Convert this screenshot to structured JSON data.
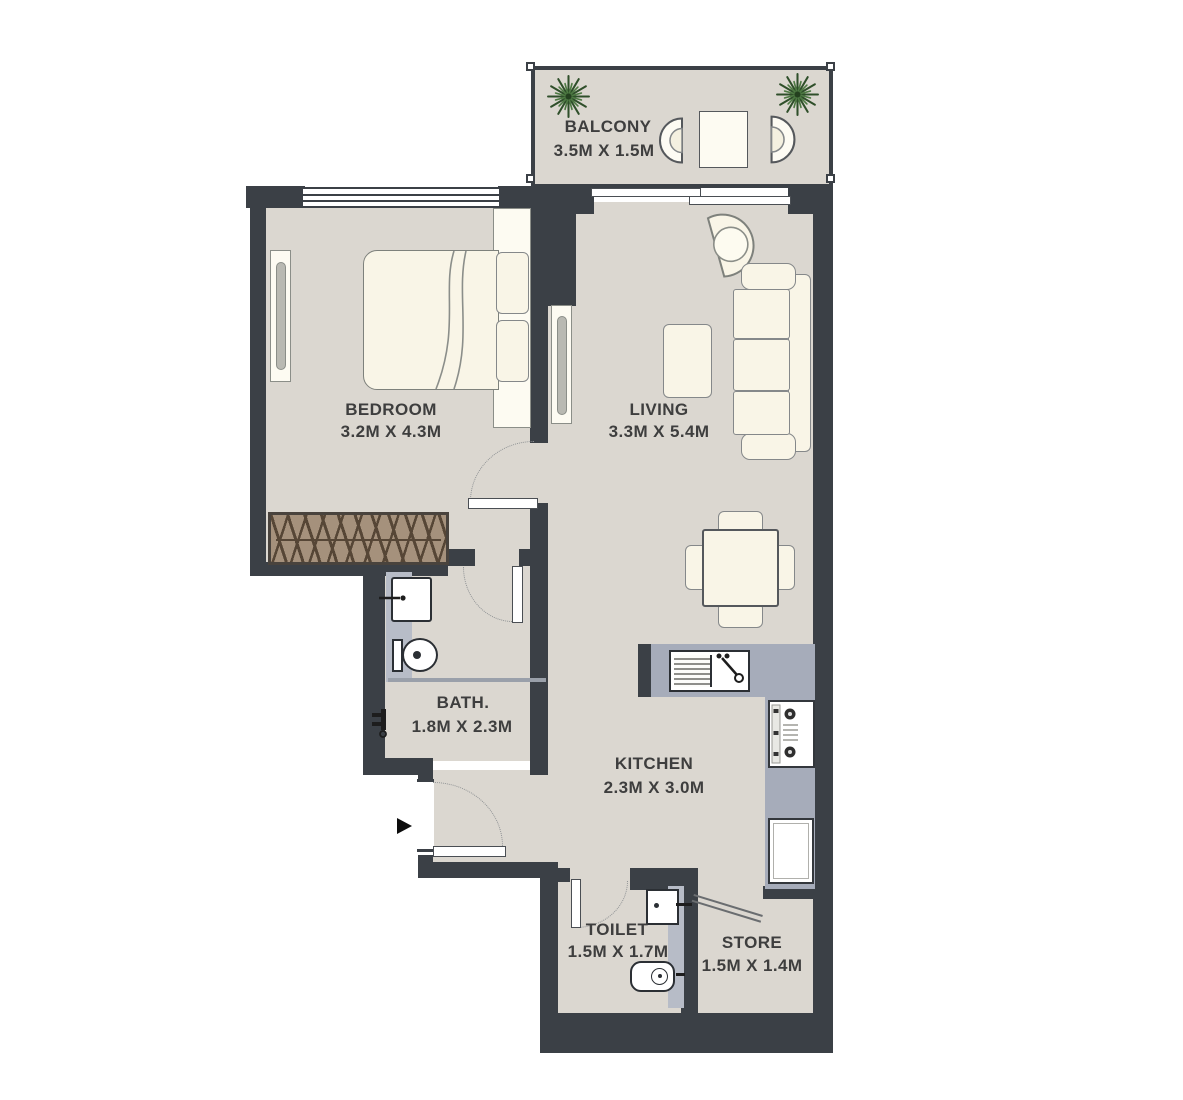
{
  "title": "One-bedroom apartment floor plan",
  "rooms": [
    {
      "name": "balcony",
      "label": "BALCONY",
      "dims": "3.5M X 1.5M"
    },
    {
      "name": "bedroom",
      "label": "BEDROOM",
      "dims": "3.2M X 4.3M"
    },
    {
      "name": "living",
      "label": "LIVING",
      "dims": "3.3M X 5.4M"
    },
    {
      "name": "bath",
      "label": "BATH.",
      "dims": "1.8M X 2.3M"
    },
    {
      "name": "kitchen",
      "label": "KITCHEN",
      "dims": "2.3M X 3.0M"
    },
    {
      "name": "toilet",
      "label": "TOILET",
      "dims": "1.5M X 1.7M"
    },
    {
      "name": "store",
      "label": "STORE",
      "dims": "1.5M X 1.4M"
    }
  ],
  "colors": {
    "wall": "#3b4046",
    "floor": "#dbd7d0",
    "counter": "#a6acba",
    "fixture_strip": "#b7bcc7",
    "furniture": "#f9f5e7",
    "wardrobe": "#a5917c",
    "plant": "#3f6339",
    "text": "#3e3e3e"
  }
}
